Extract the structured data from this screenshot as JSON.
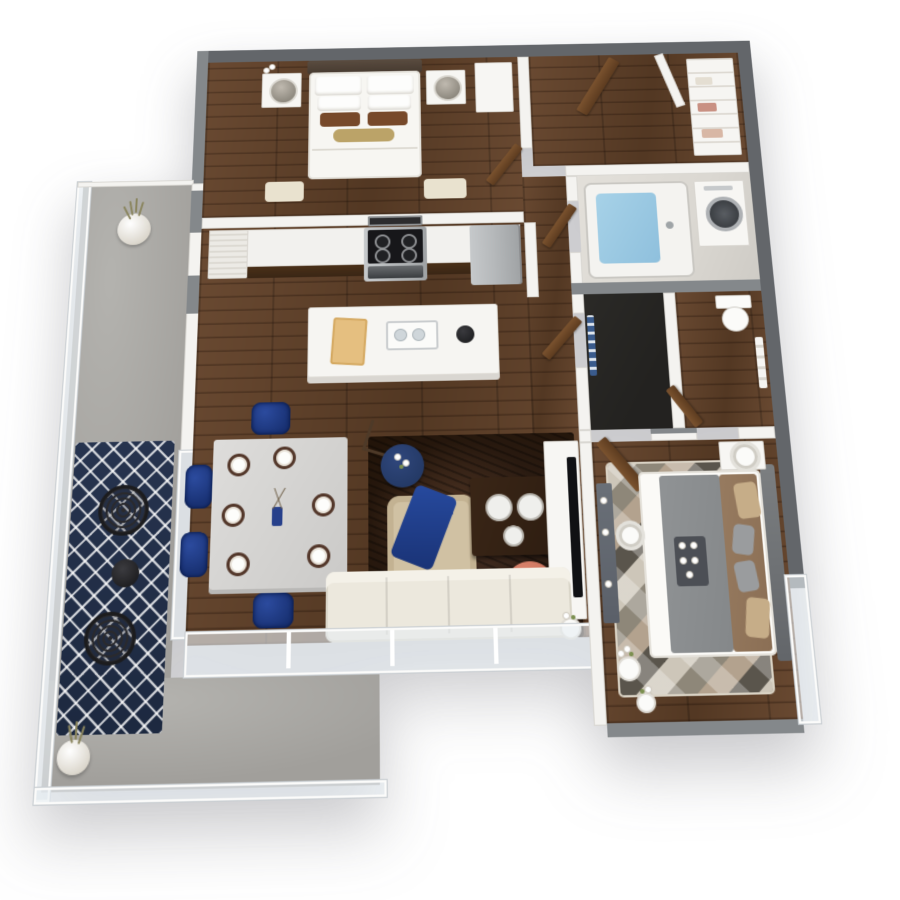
{
  "scene": {
    "type": "3d-isometric-floorplan-render",
    "description": "Top-down 3D rendering of a one-bedroom-plus-den style apartment with wrap-around balcony",
    "background": "#ffffff"
  },
  "palette": {
    "wallDark": "#63666a",
    "wallCap": "#84888b",
    "wallWhite": "#f4f3f0",
    "wood1": "#6a4a32",
    "wood2": "#533823",
    "concrete": "#a19f9b",
    "tile": "#dbd8d2",
    "charcoal": "#232220",
    "navy": "#1a3376",
    "navyRug": "#1d2940",
    "coral": "#c9705a",
    "tanChair": "#d0c1a3",
    "sofaCream": "#ece8dd",
    "darkRug": "#221409",
    "tableDark": "#2c1c10",
    "brick": "#e4c favorite",
    "brickTan": "#e6cc96",
    "brickLine": "#b08c52",
    "steel": "#b6b9bb",
    "applianceBlack": "#17181a",
    "tubWater": "#8fc0dd",
    "doorBrown": "#5d3c20",
    "duvetGray": "#85888a",
    "blanketBrown": "#8b6f55",
    "pillowTan": "#c6ad88",
    "headboardDark": "#463a30",
    "cabinetDark": "#3a2615",
    "geo1": "#cdc6b9",
    "geo2": "#8e8779",
    "geo3": "#5a554c",
    "geo4": "#b3a28e",
    "dresserGray": "#5b6069"
  },
  "rooms": {
    "balcony": {
      "name": "Wrap-around balcony",
      "floor": "concrete",
      "items": [
        "grass-planter-top",
        "grass-planter-corner",
        "trellis-rug",
        "wire-chair",
        "wire-chair",
        "bistro-table",
        "glass-railing"
      ]
    },
    "bedroom1": {
      "name": "Master bedroom",
      "floor": "hardwood",
      "items": [
        "double-bed",
        "headboard",
        "nightstand-left",
        "nightstand-right",
        "table-lamp",
        "table-lamp",
        "flower-vase",
        "bedside-rugs",
        "wardrobe",
        "door"
      ]
    },
    "kitchen": {
      "name": "Kitchen",
      "floor": "hardwood",
      "items": [
        "counter-run",
        "dark-base-cabinets",
        "utility-closet",
        "microwave",
        "range-cooktop",
        "oven",
        "refrigerator",
        "island",
        "cutting-board",
        "serving-tray",
        "kettle"
      ]
    },
    "entry": {
      "name": "Entry hall",
      "floor": "hardwood",
      "items": [
        "entry-door",
        "open-door-white",
        "shelf-closet",
        "stored-linens"
      ]
    },
    "bathroom1": {
      "name": "Bathroom with laundry",
      "floor": "tile",
      "items": [
        "bathtub",
        "faucet",
        "washer-dryer",
        "door"
      ]
    },
    "closet": {
      "name": "Walk-in closet",
      "floor": "dark-tile",
      "items": [
        "hanging-towel",
        "door"
      ]
    },
    "wc": {
      "name": "Water closet",
      "floor": "hardwood",
      "items": [
        "toilet",
        "hanging-towels",
        "door"
      ]
    },
    "living": {
      "name": "Living / dining room",
      "floor": "hardwood",
      "items": [
        "dining-table",
        "place-settings",
        "centerpiece-vase",
        "dining-chair",
        "dining-chair",
        "dining-chair",
        "dining-chair",
        "area-rug-dark",
        "folding-chair",
        "round-side-table",
        "armchair-tan",
        "navy-throw",
        "coffee-table",
        "serving-trays",
        "notebook",
        "coral-pouf",
        "tv-console",
        "tv-panel",
        "sofa-cream",
        "flower-vases",
        "window-wall"
      ]
    },
    "bedroom2": {
      "name": "Second bedroom",
      "floor": "hardwood",
      "items": [
        "queen-bed",
        "headboard-panel",
        "gray-duvet",
        "brown-blanket",
        "accent-pillows",
        "breakfast-tray",
        "geometric-rug",
        "nightstand",
        "cylinder-lamp",
        "floor-lamp",
        "dresser",
        "flower-vase",
        "flower-vase",
        "door",
        "window-wall",
        "brick-ledge"
      ]
    }
  }
}
